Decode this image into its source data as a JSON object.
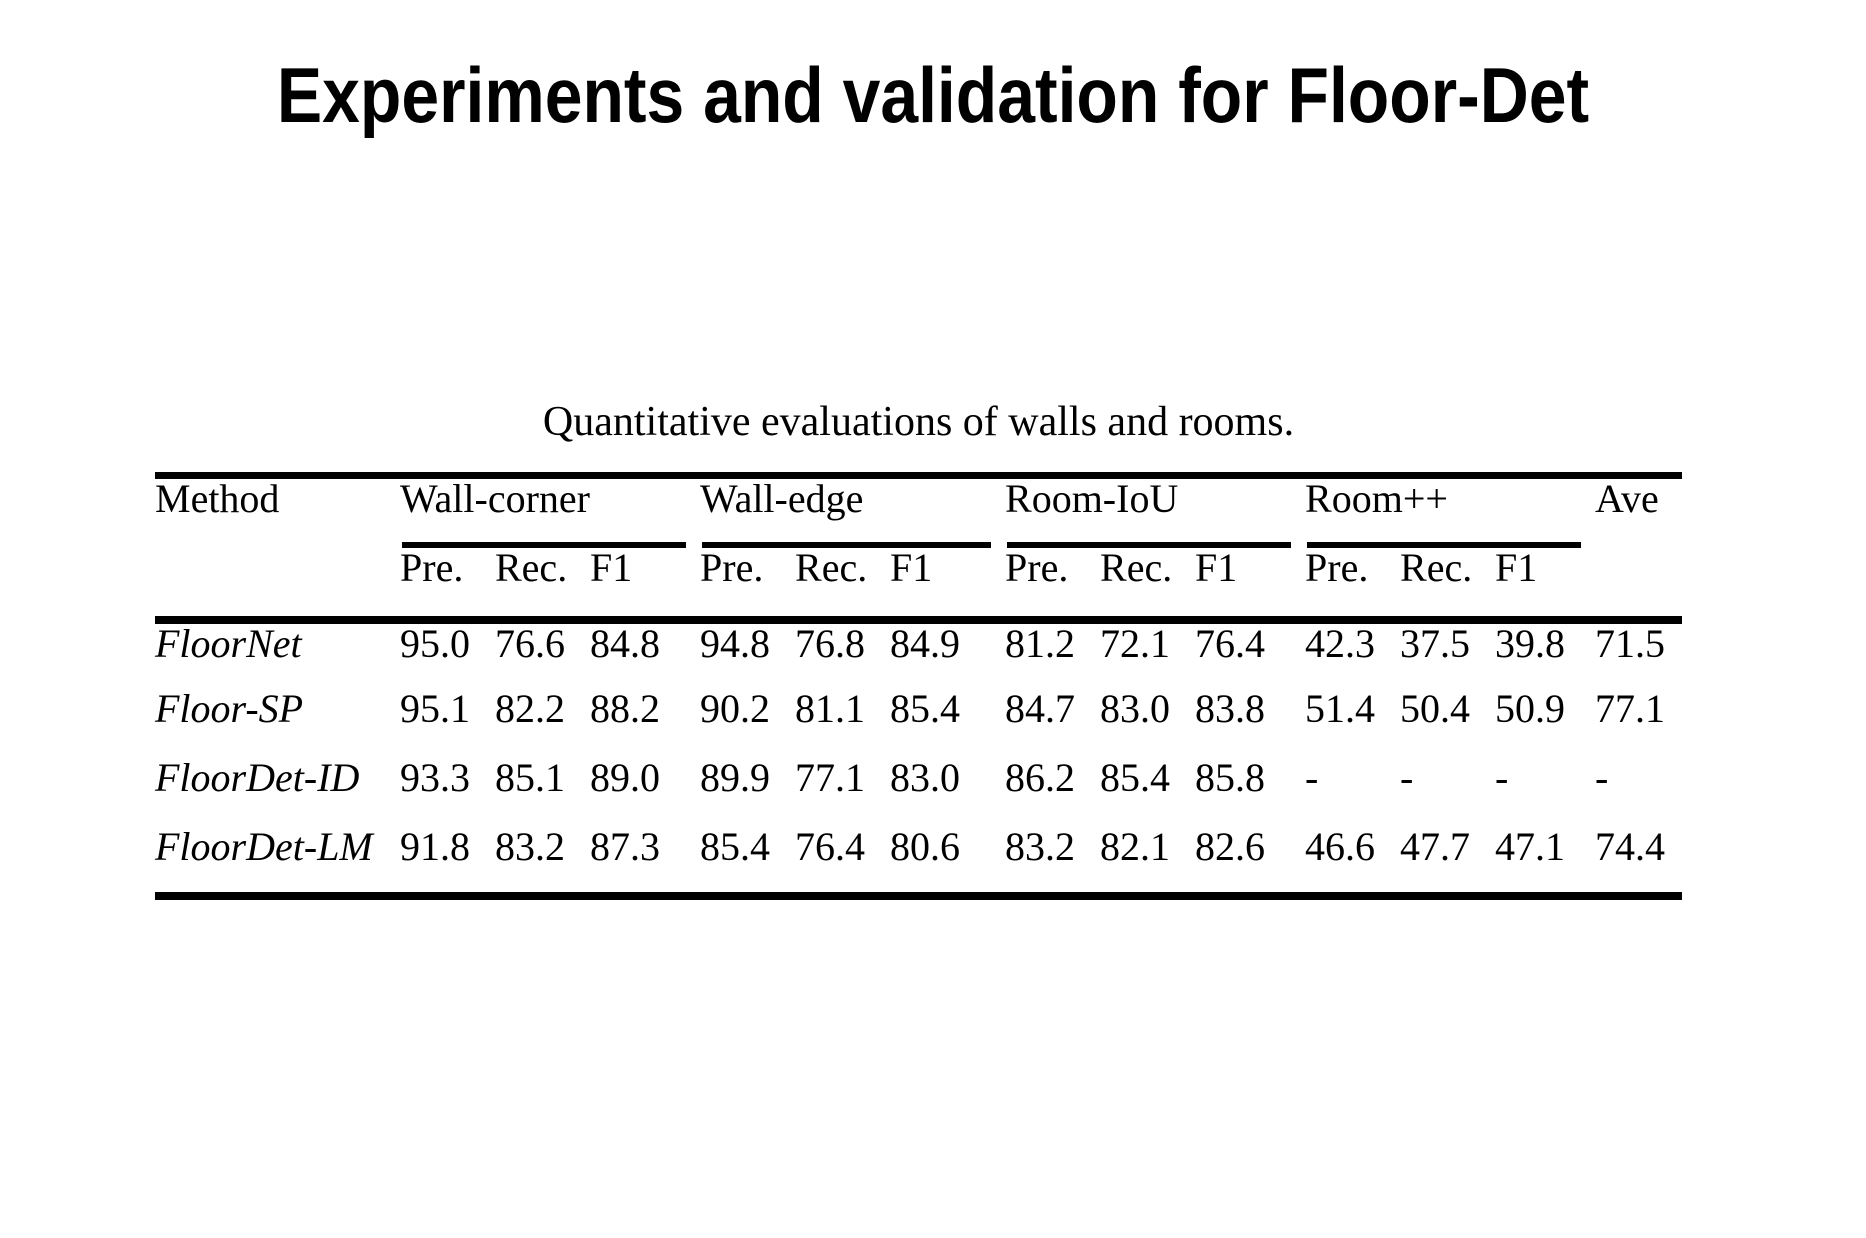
{
  "page": {
    "background": "#ffffff",
    "text_color": "#000000",
    "rule_color": "#000000"
  },
  "title": "Experiments and validation for Floor-Det",
  "table": {
    "caption": "Quantitative evaluations of walls and rooms.",
    "method_header": "Method",
    "ave_header": "Ave",
    "groups": [
      {
        "label": "Wall-corner",
        "subcols": [
          "Pre.",
          "Rec.",
          "F1"
        ]
      },
      {
        "label": "Wall-edge",
        "subcols": [
          "Pre.",
          "Rec.",
          "F1"
        ]
      },
      {
        "label": "Room-IoU",
        "subcols": [
          "Pre.",
          "Rec.",
          "F1"
        ]
      },
      {
        "label": "Room++",
        "subcols": [
          "Pre.",
          "Rec.",
          "F1"
        ]
      }
    ],
    "rows": [
      {
        "method": "FloorNet",
        "values": [
          "95.0",
          "76.6",
          "84.8",
          "94.8",
          "76.8",
          "84.9",
          "81.2",
          "72.1",
          "76.4",
          "42.3",
          "37.5",
          "39.8",
          "71.5"
        ]
      },
      {
        "method": "Floor-SP",
        "values": [
          "95.1",
          "82.2",
          "88.2",
          "90.2",
          "81.1",
          "85.4",
          "84.7",
          "83.0",
          "83.8",
          "51.4",
          "50.4",
          "50.9",
          "77.1"
        ]
      },
      {
        "method": "FloorDet-ID",
        "values": [
          "93.3",
          "85.1",
          "89.0",
          "89.9",
          "77.1",
          "83.0",
          "86.2",
          "85.4",
          "85.8",
          "-",
          "-",
          "-",
          "-"
        ]
      },
      {
        "method": "FloorDet-LM",
        "values": [
          "91.8",
          "83.2",
          "87.3",
          "85.4",
          "76.4",
          "80.6",
          "83.2",
          "82.1",
          "82.6",
          "46.6",
          "47.7",
          "47.1",
          "74.4"
        ]
      }
    ]
  }
}
